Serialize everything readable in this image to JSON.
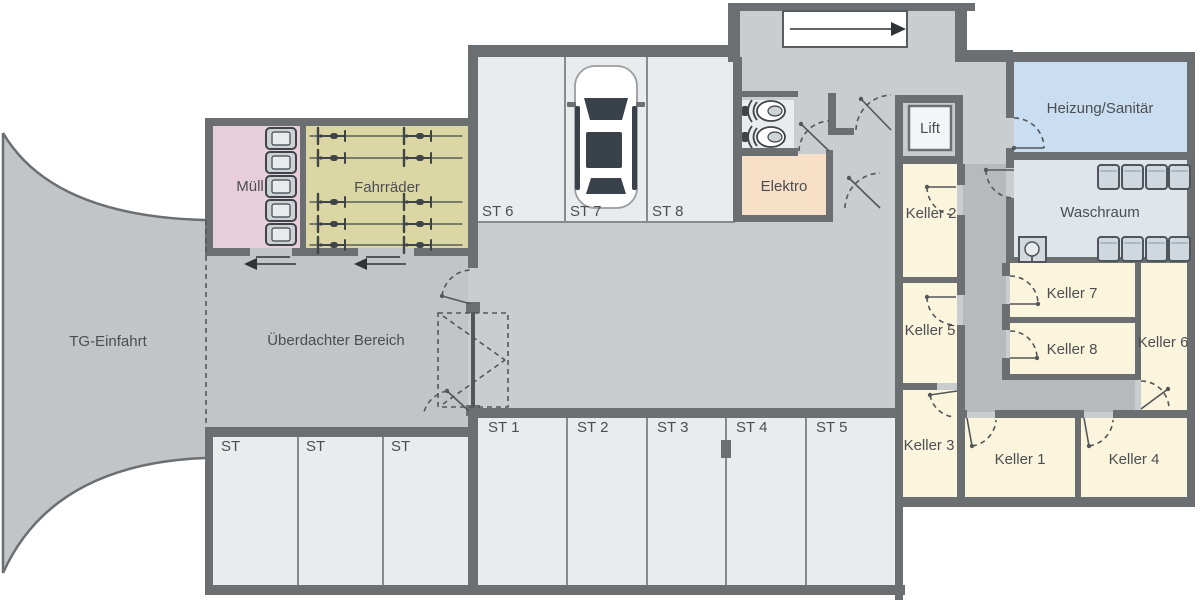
{
  "labels": {
    "entrance": "TG-Einfahrt",
    "covered_area": "Überdachter Bereich",
    "trash_room": "Müll",
    "bike_room": "Fahrräder",
    "electrical_room": "Elektro",
    "lift": "Lift",
    "heating_room": "Heizung/Sanitär",
    "laundry_room": "Waschraum"
  },
  "cellars": {
    "k1": "Keller 1",
    "k2": "Keller 2",
    "k3": "Keller 3",
    "k4": "Keller 4",
    "k5": "Keller 5",
    "k6": "Keller 6",
    "k7": "Keller 7",
    "k8": "Keller 8"
  },
  "parking": {
    "st1": "ST 1",
    "st2": "ST 2",
    "st3": "ST 3",
    "st4": "ST 4",
    "st5": "ST 5",
    "st6": "ST 6",
    "st7": "ST 7",
    "st8": "ST 8",
    "unnumbered": [
      "ST",
      "ST",
      "ST"
    ]
  },
  "colors": {
    "wall": "#6b6f72",
    "floor": "#c2c5c7",
    "garage": "#cacdcf",
    "corridor": "#b7babc",
    "parking": "#e9ebed",
    "trashroom": "#e6ceda",
    "bikeroom": "#dbd7a5",
    "electricalroom": "#f8dfc8",
    "cellar": "#fcf5dd",
    "heatingroom": "#cadef1",
    "laundryroom": "#dfe5ea",
    "liftcab": "#f4f5f6",
    "line": "#53575a",
    "text": "#4b4e51",
    "divider": "#888b8e",
    "glass": "#39424a",
    "machine": "#cfd8de"
  }
}
